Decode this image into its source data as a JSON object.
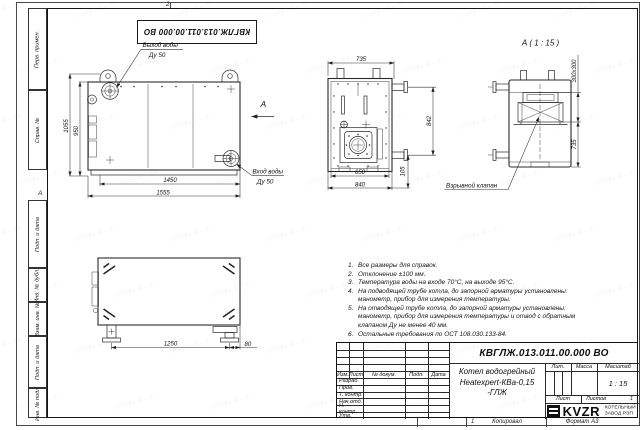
{
  "doc_number": "КВГЛЖ.013.011.00.000 ВО",
  "watermark": {
    "text": "kotel-kv.kz"
  },
  "frame": {
    "zone_top": "2",
    "zone_left": "А",
    "sheet_small_num": "1",
    "copy_label": "Копировал",
    "format_label": "Формат А3",
    "margin_labels": [
      "Перв. примен.",
      "Справ. №",
      "Подп. и дата",
      "Инв. № дубл.",
      "Взам. инв. №",
      "Подп. и дата",
      "Инв. № подл."
    ]
  },
  "front_view": {
    "arrow_label": "А",
    "outlet_label": "Выход воды",
    "outlet_size": "Ду 50",
    "inlet_label": "Вход воды",
    "inlet_size": "Ду 50",
    "dim_height_overall": "1055",
    "dim_height_body": "950",
    "dim_width_inner": "1450",
    "dim_width_overall": "1555"
  },
  "side_view": {
    "dim_depth": "735",
    "dim_height": "842",
    "dim_width_inner": "650",
    "dim_width_overall": "840",
    "dim_pipe_offset": "105"
  },
  "back_view": {
    "title": "А ( 1 : 15 )",
    "valve_label": "Взрывной клапан",
    "dim_valve": "300х300",
    "dim_height": "735"
  },
  "bottom_view": {
    "dim_feet": "1250",
    "dim_offset": "80"
  },
  "notes": {
    "items": [
      {
        "n": "1.",
        "text": "Все размеры для справок."
      },
      {
        "n": "2.",
        "text": "Отклонение ±100 мм."
      },
      {
        "n": "3.",
        "text": "Температура воды на входе 70°С, на выходе 95°С."
      },
      {
        "n": "4.",
        "text": "На подводящей трубе котла, до запорной арматуры установлены: манометр, прибор для измерения температуры."
      },
      {
        "n": "5.",
        "text": "На отводящей трубе котла, до запорной арматуры установлены: манометр, прибор для измерения температуры и отвод с обратным клапаном Ду не менее 40 мм."
      },
      {
        "n": "6.",
        "text": "Остальные требования по ОСТ 108.030.133-84."
      }
    ]
  },
  "titleblock": {
    "name_line1": "Котел водогрейный",
    "name_line2": "Heatexpert-КВа-0,15 -ГЛЖ",
    "col_izm": "Изм.",
    "col_list": "Лист",
    "col_doc": "№ докум.",
    "col_podp": "Подп.",
    "col_data": "Дата",
    "sig_rows": [
      "Разраб.",
      "Пров.",
      "Т. контр.",
      "Нач.отд.",
      "Н. контр.",
      "Утв."
    ],
    "lit_label": "Лит.",
    "mass_label": "Масса",
    "scale_label": "Масштаб",
    "scale_value": "1 : 15",
    "sheet_label": "Лист",
    "sheets_label": "Листов",
    "sheets_value": "1",
    "logo_text": "KVZR",
    "logo_sub1": "КОТЕЛЬНЫЙ",
    "logo_sub2": "ЗАВОД РЭП"
  }
}
